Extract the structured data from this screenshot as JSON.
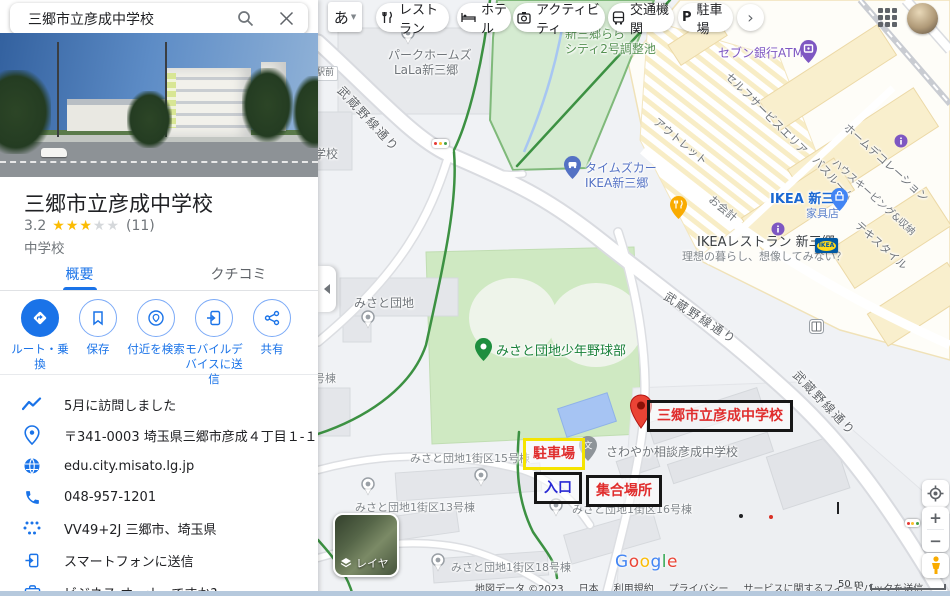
{
  "search": {
    "query": "三郷市立彦成中学校"
  },
  "place": {
    "name": "三郷市立彦成中学校",
    "rating": "3.2",
    "stars_on": "★★★",
    "stars_off": "★★",
    "reviews": "(11)",
    "category": "中学校"
  },
  "tabs": [
    {
      "label": "概要"
    },
    {
      "label": "クチコミ"
    }
  ],
  "actions": [
    {
      "label": "ルート・乗換"
    },
    {
      "label": "保存"
    },
    {
      "label": "付近を検索"
    },
    {
      "label": "モバイルデバイスに送信"
    },
    {
      "label": "共有"
    }
  ],
  "info": [
    {
      "text": "5月に訪問しました"
    },
    {
      "text": "〒341-0003 埼玉県三郷市彦成４丁目１-１９"
    },
    {
      "text": "edu.city.misato.lg.jp"
    },
    {
      "text": "048-957-1201"
    },
    {
      "text": "VV49+2J 三郷市、埼玉県"
    },
    {
      "text": "スマートフォンに送信"
    },
    {
      "text": "ビジネス オーナーですか?"
    }
  ],
  "topbar": {
    "ime": "あ",
    "chips": [
      {
        "label": "レストラン"
      },
      {
        "label": "ホテル"
      },
      {
        "label": "アクティビティ"
      },
      {
        "label": "交通機関"
      },
      {
        "label": "駐車場",
        "icon_letter": "P"
      }
    ]
  },
  "map": {
    "labels": [
      {
        "text": "パークホームズ"
      },
      {
        "text": "LaLa新三郷"
      },
      {
        "text": "新三郷らら"
      },
      {
        "text": "シティ2号調整池"
      },
      {
        "text": "武蔵野線通り"
      },
      {
        "text": "武蔵野線通り"
      },
      {
        "text": "武蔵野線通り"
      },
      {
        "text": "学校"
      },
      {
        "text": "駅前"
      },
      {
        "text": "タイムズカー"
      },
      {
        "text": "IKEA新三郷"
      },
      {
        "text": "セブン銀行ATM"
      },
      {
        "text": "セルフサービスエリア"
      },
      {
        "text": "アウトレット"
      },
      {
        "text": "ホームデコレーション"
      },
      {
        "text": "バスルーム"
      },
      {
        "text": "ハウスキーピング&収納"
      },
      {
        "text": "テキスタイル"
      },
      {
        "text": "お会計"
      },
      {
        "text": "IKEA 新三郷"
      },
      {
        "text": "家具店"
      },
      {
        "text": "IKEAレストラン 新三郷"
      },
      {
        "text": "理想の暮らし、想像してみない？"
      },
      {
        "text": "IKEA"
      },
      {
        "text": "みさと団地"
      },
      {
        "text": "みさと団地少年野球部"
      },
      {
        "text": "さわやか相談彦成中学校"
      },
      {
        "text": "みさと団地1街区15号棟"
      },
      {
        "text": "みさと団地1街区13号棟"
      },
      {
        "text": "みさと団地1街区18号棟"
      },
      {
        "text": "みさと団地1街区16号棟"
      },
      {
        "text": "16号棟"
      }
    ],
    "annotations": {
      "school": "三郷市立彦成中学校",
      "parking": "駐車場",
      "entrance": "入口",
      "meeting": "集合場所"
    },
    "colors": {
      "accent": "#1a73e8",
      "star": "#fbbc04",
      "annotation_red": "#e02d2d",
      "annotation_blue": "#2929d4",
      "annotation_yellow_border": "#f5e400",
      "annotation_black_border": "#161616",
      "route_green": "#3c9142"
    },
    "layers_label": "レイヤ",
    "scale_label": "50 m",
    "logo_letters": [
      {
        "ch": "G",
        "color": "#4285F4"
      },
      {
        "ch": "o",
        "color": "#EA4335"
      },
      {
        "ch": "o",
        "color": "#FBBC05"
      },
      {
        "ch": "g",
        "color": "#4285F4"
      },
      {
        "ch": "l",
        "color": "#34A853"
      },
      {
        "ch": "e",
        "color": "#EA4335"
      }
    ],
    "attribution": [
      {
        "text": "地図データ ©2023"
      },
      {
        "text": "日本"
      },
      {
        "text": "利用規約"
      },
      {
        "text": "プライバシー"
      },
      {
        "text": "サービスに関するフィードバックを送信"
      }
    ]
  }
}
